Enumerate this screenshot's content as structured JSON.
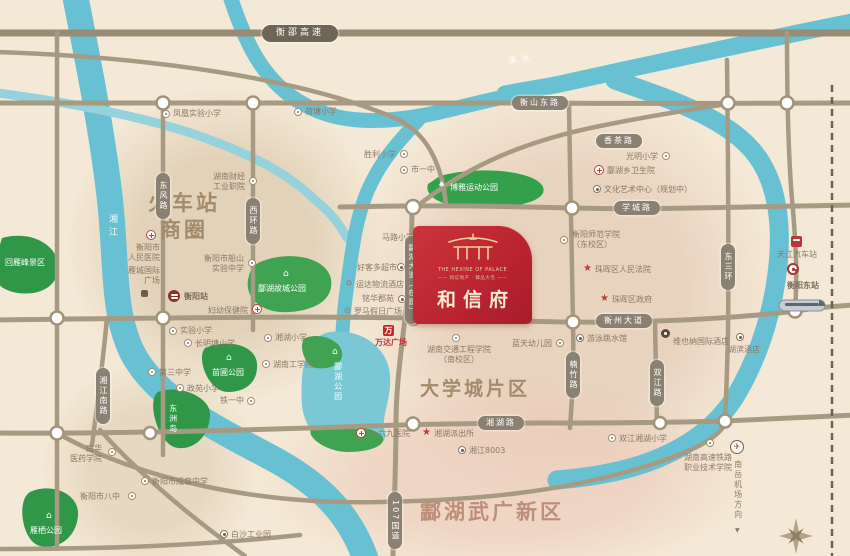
{
  "project": {
    "name_cn": "和信府",
    "name_en": "THE HEXINE OF PALACE",
    "tagline": "—— 和信地产 · 臻品大宅 ——"
  },
  "areas": {
    "station_line1": "火车站",
    "station_line2": "商圈",
    "university": "大学城片区",
    "wuguang": "酃湖武广新区"
  },
  "rivers": {
    "xiangjiang": "湘江",
    "leishui": "耒水"
  },
  "roads": {
    "expressway": "衡邵高速",
    "hengshandong": "衡山东路",
    "xiangcha": "香茶路",
    "xuecheng": "学城路",
    "dongfeng": "东风路",
    "xihuan": "西环路",
    "linghu_avenue": "酃湖大道（在建）",
    "hengzhou": "衡州大道",
    "nanzhu": "楠竹路",
    "shuangjiang": "双江路",
    "dongsanhuan": "东三环",
    "xiangjiangnan": "湘江南路",
    "xianghu": "湘湖路",
    "g107": "107国道"
  },
  "parks": {
    "huiyanfeng": "回雁峰景区",
    "gucheng": "酃湖故城公园",
    "boya": "博雅运动公园",
    "linghu": "酃湖公园",
    "miaopu": "苗圃公园",
    "dongzhou": "东洲岛",
    "yanqi": "雁栖公园"
  },
  "labels": {
    "fenghuang_school": "凤凰实验小学",
    "hetang_school": "荷塘小学",
    "shengli_school": "胜利小学",
    "no1_middle": "市一中",
    "malu_school": "马路小学",
    "haokeduo": "好客多超市",
    "yunda_hotel": "运达物流酒店",
    "minghua": "铭华郡苑",
    "roman_plaza": "罗马假日广场",
    "wanda": "万达广场",
    "caijing_l1": "湖南财经",
    "caijing_l2": "工业职院",
    "renmin_l1": "衡阳市",
    "renmin_l2": "人民医院",
    "intl_l1": "雁城国际",
    "intl_l2": "广场",
    "hengyang_station": "衡阳站",
    "fuyou": "妇幼保健院",
    "chuanshan_l1": "衡阳市船山",
    "chuanshan_l2": "实验中学",
    "xianghu_school": "湘湖小学",
    "gongxueyuan": "湖南工学院",
    "no3_middle": "第三中学",
    "changmingtang": "长明塘小学",
    "shiyan_school": "实验小学",
    "zhengyuan": "政苑小学",
    "tieyizhong": "铁一中",
    "bazhong": "衡阳市八中",
    "chengzhang": "衡阳市成章中学",
    "nanhua_l1": "南华",
    "nanhua_l2": "医药学院",
    "hospital169": "一六九医院",
    "paichusuo": "湘湖派出所",
    "xj8003": "湘江8003",
    "jiaotong_l1": "湖南交通工程学院",
    "jiaotong_l2": "（南校区）",
    "lantian": "蓝天幼儿园",
    "shifan_l1": "衡阳师范学院",
    "shifan_l2": "（东校区）",
    "fayuan": "珠晖区人民法院",
    "quzhengfu": "珠晖区政府",
    "youyong": "游泳跳水馆",
    "weishengyuan": "酃湖乡卫生院",
    "wenhua": "文化艺术中心（规划中）",
    "guangming_school": "光明小学",
    "vienna": "维也纳国际酒店",
    "hubin_hotel": "湖滨酒店",
    "shuangjiang_school": "双江湘湖小学",
    "tianjiang_bus": "天江汽车站",
    "dongzhan": "衡阳东站",
    "gaotie_l1": "湖南高速铁路",
    "gaotie_l2": "职业技术学院",
    "airport": "南岳机场方向",
    "baisha": "白沙工业园"
  },
  "icons": {
    "star": "★",
    "plane": "✈",
    "house": "⌂",
    "pavilion": "⌂",
    "tree": "♠",
    "wanda_w": "万",
    "down_arrow": "▼",
    "double_circle": "◎"
  }
}
